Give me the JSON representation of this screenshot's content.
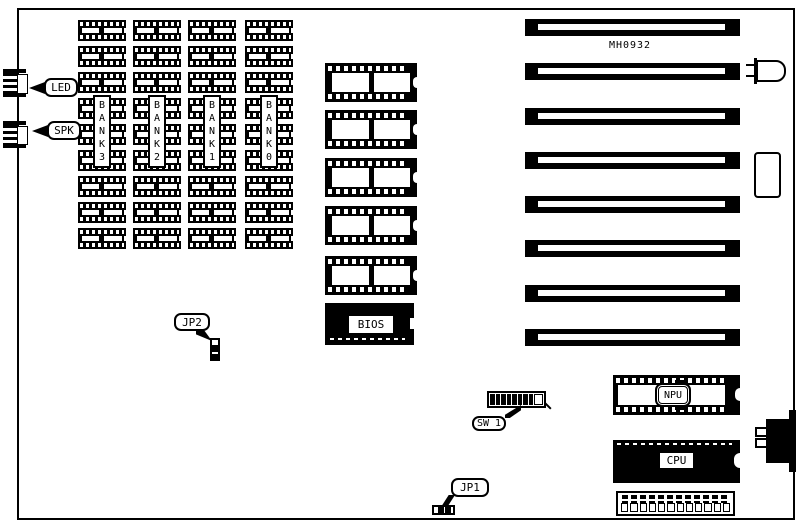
{
  "board": {
    "code": "MH0932"
  },
  "connectors": {
    "led_label": "LED",
    "spk_label": "SPK",
    "jp1_label": "JP1",
    "jp2_label": "JP2",
    "sw1_label": "SW 1"
  },
  "chips": {
    "bios_label": "BIOS",
    "npu_label": "NPU",
    "cpu_label": "CPU"
  },
  "memory": {
    "chips_per_bank": 9,
    "banks": [
      {
        "label": "BANK3"
      },
      {
        "label": "BANK2"
      },
      {
        "label": "BANK1"
      },
      {
        "label": "BANK0"
      }
    ]
  },
  "slots": {
    "count": 8
  },
  "eproms": {
    "count": 5
  },
  "sw1": {
    "on_segments": 8
  },
  "power_connector": {
    "pin_cells": 12
  },
  "colors": {
    "ink": "#000000",
    "paper": "#ffffff"
  }
}
